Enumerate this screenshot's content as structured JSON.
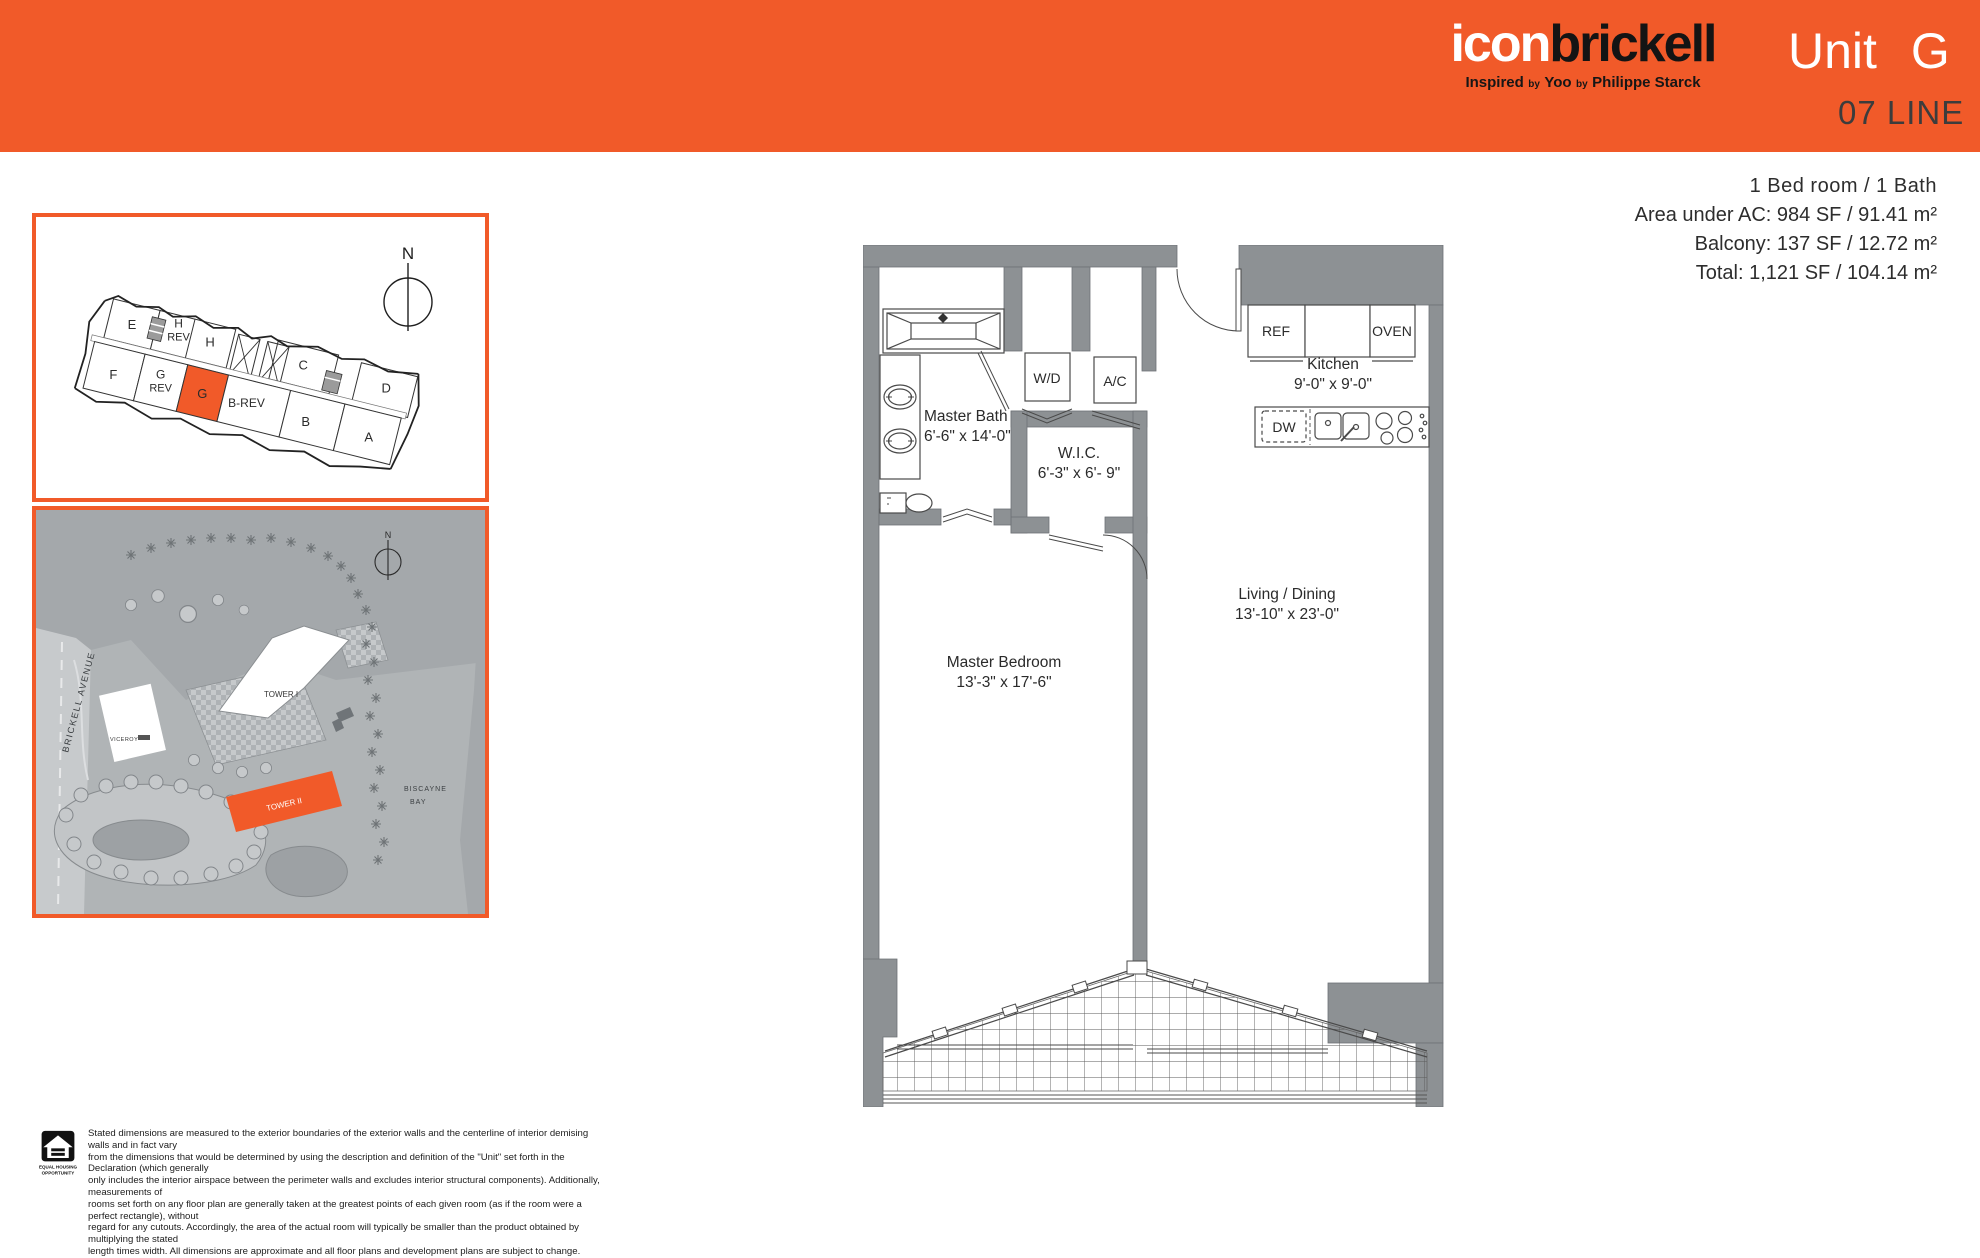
{
  "header": {
    "logo": {
      "part1": "icon",
      "part2": "brickell"
    },
    "tagline": {
      "lead": "Inspired",
      "by": "by",
      "yoo": "Yoo",
      "starck": "Philippe Starck"
    },
    "unit_label": "Unit",
    "unit_value": "G",
    "line_label": "07 LINE"
  },
  "summary": {
    "bed_bath": "1 Bed room / 1 Bath",
    "area": "Area under AC: 984 SF / 91.41 m²",
    "balcony": "Balcony: 137 SF / 12.72 m²",
    "total": "Total: 1,121 SF / 104.14 m²"
  },
  "keyplan": {
    "north": "N",
    "units": {
      "e": "E",
      "h_rev_1": "H",
      "h_rev_2": "REV",
      "h": "H",
      "c": "C",
      "d": "D",
      "f": "F",
      "g_rev_1": "G",
      "g_rev_2": "REV",
      "g": "G",
      "b_rev": "B-REV",
      "b": "B",
      "a": "A"
    }
  },
  "siteplan": {
    "north": "N",
    "brickell_avenue": "BRICKELL AVENUE",
    "viceroy": "VICEROY",
    "tower1": "TOWER I",
    "tower2": "TOWER II",
    "bay_1": "BISCAYNE",
    "bay_2": "BAY"
  },
  "floorplan": {
    "master_bath": {
      "name": "Master Bath",
      "dims": "6'-6\" x 14'-0\""
    },
    "wic": {
      "name": "W.I.C.",
      "dims": "6'-3\" x 6'- 9\""
    },
    "kitchen": {
      "name": "Kitchen",
      "dims": "9'-0\" x 9'-0\""
    },
    "living": {
      "name": "Living / Dining",
      "dims": "13'-10\" x 23'-0\""
    },
    "bedroom": {
      "name": "Master Bedroom",
      "dims": "13'-3\" x 17'-6\""
    },
    "wd": "W/D",
    "ac": "A/C",
    "ref": "REF",
    "oven": "OVEN",
    "dw": "DW"
  },
  "disclaimer": {
    "logo_line1": "EQUAL HOUSING",
    "logo_line2": "OPPORTUNITY",
    "lines": [
      "Stated dimensions are measured to the exterior boundaries of the exterior walls and the centerline of interior demising walls and in fact vary",
      "from the dimensions that would be determined by using the description and definition of the \"Unit\" set forth in the Declaration (which generally",
      "only includes the interior airspace between the perimeter walls and excludes interior structural components). Additionally, measurements of",
      "rooms set forth on any floor plan are generally taken at the greatest points of each given room (as if the room were a perfect rectangle), without",
      "regard for any cutouts. Accordingly, the area of the actual room will typically be smaller than the product obtained by multiplying the stated",
      "length times width. All dimensions are approximate and all floor plans and development plans are subject to change."
    ]
  },
  "colors": {
    "accent": "#F15A29",
    "wall": "#8D9194"
  }
}
